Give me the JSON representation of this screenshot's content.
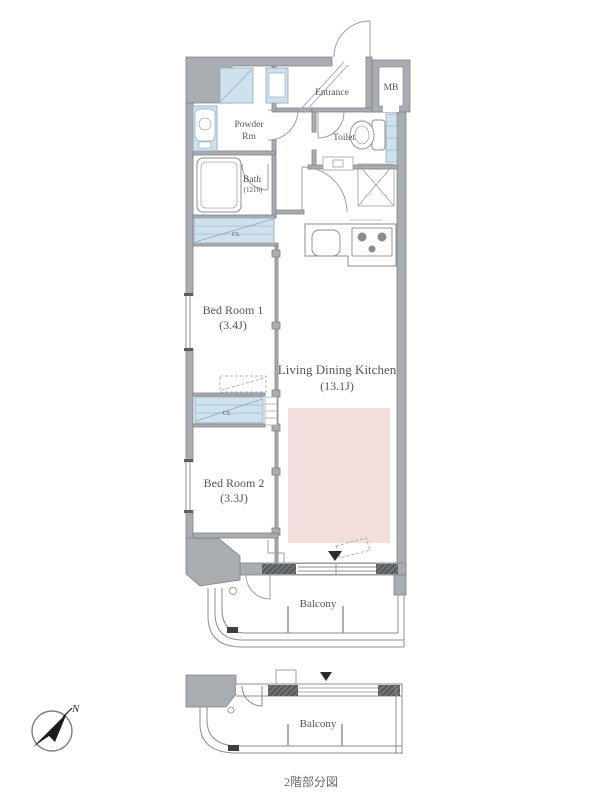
{
  "colors": {
    "wall_gray": "#a9adb1",
    "wall_edge": "#7f8386",
    "line_gray": "#8a8d90",
    "fixture_blue": "#cfe1ec",
    "fixture_blue_edge": "#8fa9bb",
    "rug_pink": "#f2dfdb",
    "text_gray": "#55585a"
  },
  "compass": {
    "north_label": "N"
  },
  "main_plan": {
    "rooms": {
      "entrance": {
        "label": "Entrance"
      },
      "meter_box": {
        "label": "MB"
      },
      "toilet": {
        "label": "Toilet"
      },
      "powder_room": {
        "line1": "Powder",
        "line2": "Rm"
      },
      "bath": {
        "line1": "Bath",
        "line2": "(1216)"
      },
      "closet1": {
        "label": "CL"
      },
      "closet2": {
        "label": "CL"
      },
      "bedroom1": {
        "line1": "Bed Room 1",
        "line2": "(3.4J)"
      },
      "bedroom2": {
        "line1": "Bed Room 2",
        "line2": "(3.3J)"
      },
      "ldk": {
        "line1": "Living Dining Kitchen",
        "line2": "(13.1J)"
      },
      "balcony": {
        "label": "Balcony"
      }
    }
  },
  "partial_plan": {
    "balcony": {
      "label": "Balcony"
    },
    "caption": "2階部分図"
  }
}
